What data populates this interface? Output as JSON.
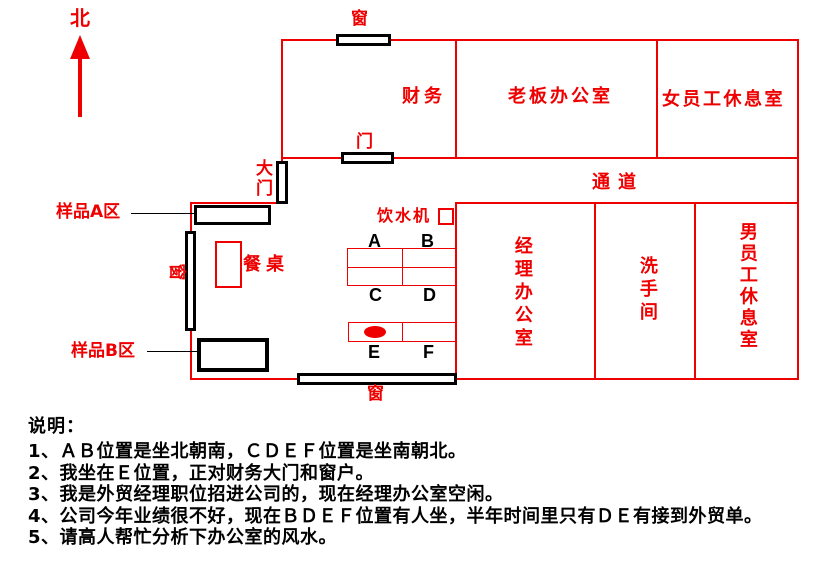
{
  "compass": {
    "north_label": "北"
  },
  "plan": {
    "rooms": {
      "finance": "财务",
      "boss_office": "老板办公室",
      "female_staff_lounge": "女员工休息室",
      "corridor": "通道",
      "manager_office": "经理办公室",
      "washroom": "洗手间",
      "male_staff_lounge": "男员工休息室"
    },
    "fixtures": {
      "window_top": "窗",
      "door": "门",
      "main_gate": "大门",
      "window_left": "窗",
      "window_bottom": "窗",
      "water_dispenser": "饮水机",
      "dining_table": "餐桌",
      "sample_area_a": "样品A区",
      "sample_area_b": "样品B区"
    },
    "seats": [
      "A",
      "B",
      "C",
      "D",
      "E",
      "F"
    ]
  },
  "notes": {
    "title": "说明：",
    "lines": [
      "1、ＡＢ位置是坐北朝南，ＣＤＥＦ位置是坐南朝北。",
      "2、我坐在Ｅ位置，正对财务大门和窗户。",
      "3、我是外贸经理职位招进公司的，现在经理办公室空闲。",
      "4、公司今年业绩很不好，现在ＢＤＥＦ位置有人坐，半年时间里只有ＤＥ有接到外贸单。",
      "5、请高人帮忙分析下办公室的风水。"
    ]
  },
  "colors": {
    "accent_red": "#ee0000",
    "ink_black": "#000000"
  }
}
